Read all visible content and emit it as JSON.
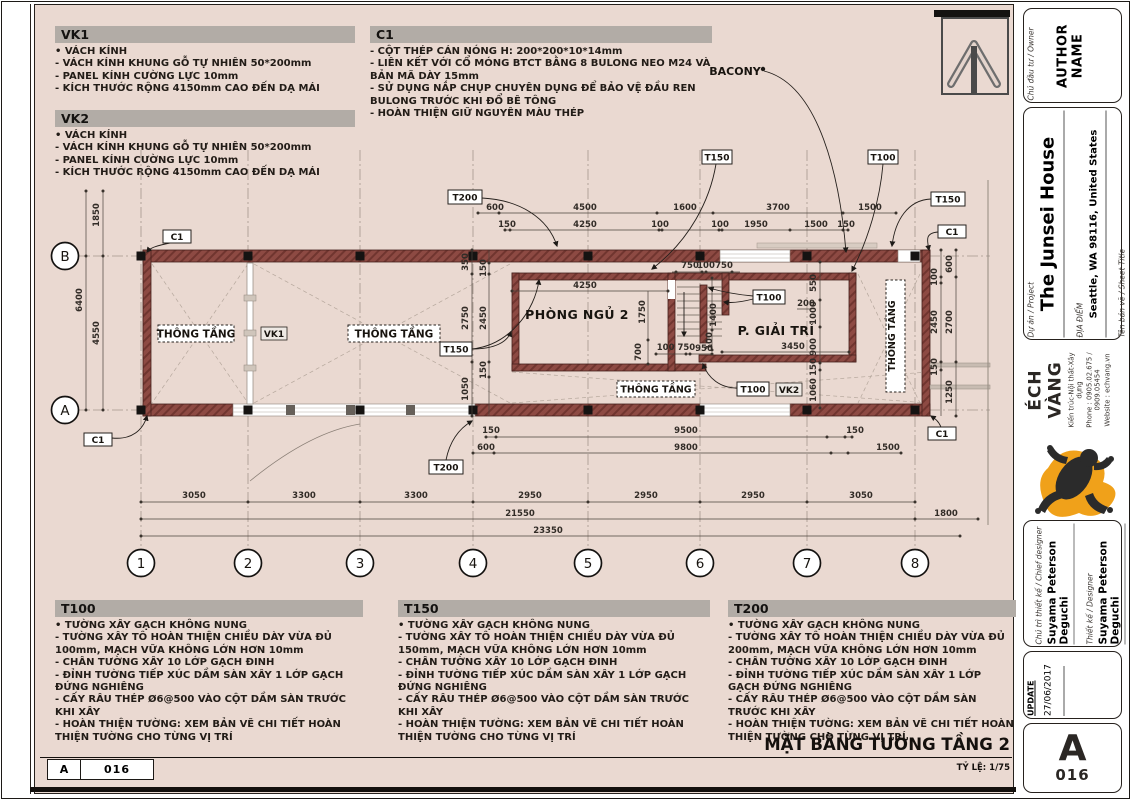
{
  "notes": {
    "vk1": {
      "title": "VK1",
      "lines": [
        "• VÁCH KÍNH",
        "- VÁCH KÍNH KHUNG GỖ TỰ NHIÊN 50*200mm",
        "- PANEL KÍNH CƯỜNG LỰC 10mm",
        "- KÍCH THƯỚC RỘNG 4150mm CAO ĐẾN DẠ MÁI"
      ]
    },
    "vk2": {
      "title": "VK2",
      "lines": [
        "• VÁCH KÍNH",
        "- VÁCH KÍNH KHUNG GỖ TỰ NHIÊN 50*200mm",
        "- PANEL KÍNH CƯỜNG LỰC 10mm",
        "- KÍCH THƯỚC RỘNG 4150mm CAO ĐẾN DẠ MÁI"
      ]
    },
    "c1": {
      "title": "C1",
      "lines": [
        "- CỘT THÉP CÁN NÓNG H: 200*200*10*14mm",
        "- LIÊN KẾT VỚI CỔ MÓNG BTCT BẰNG 8 BULONG NEO M24 VÀ BẢN MÃ DÀY 15mm",
        "- SỬ DỤNG NẮP CHỤP CHUYÊN DỤNG ĐỂ BẢO VỆ ĐẦU REN BULONG TRƯỚC KHI ĐỔ BÊ TÔNG",
        "- HOÀN THIỆN GIỮ NGUYÊN MÀU THÉP"
      ]
    },
    "t100": {
      "title": "T100",
      "lines": [
        "• TƯỜNG XÂY GẠCH KHÔNG NUNG",
        "- TƯỜNG XÂY TÔ HOÀN THIỆN CHIỀU DÀY VỪA ĐỦ 100mm, MẠCH VỮA KHÔNG LỚN HƠN 10mm",
        "- CHÂN TƯỜNG XÂY 10 LỚP GẠCH ĐINH",
        "- ĐỈNH TƯỜNG TIẾP XÚC DẦM SÀN XÂY 1 LỚP GẠCH ĐỨNG NGHIÊNG",
        "- CẤY RÂU THÉP Ø6@500 VÀO CỘT DẦM SÀN TRƯỚC KHI XÂY",
        "- HOÀN THIỆN TƯỜNG: XEM BẢN VẼ CHI TIẾT HOÀN THIỆN TƯỜNG CHO TỪNG VỊ TRÍ"
      ]
    },
    "t150": {
      "title": "T150",
      "lines": [
        "• TƯỜNG XÂY GẠCH KHÔNG NUNG",
        "- TƯỜNG XÂY TÔ HOÀN THIỆN CHIỀU DÀY VỪA ĐỦ 150mm, MẠCH VỮA KHÔNG LỚN HƠN 10mm",
        "- CHÂN TƯỜNG XÂY 10 LỚP GẠCH ĐINH",
        "- ĐỈNH TƯỜNG TIẾP XÚC DẦM SÀN XÂY 1 LỚP GẠCH ĐỨNG NGHIÊNG",
        "- CẤY RÂU THÉP Ø6@500 VÀO CỘT DẦM SÀN TRƯỚC KHI XÂY",
        "- HOÀN THIỆN TƯỜNG: XEM BẢN VẼ CHI TIẾT HOÀN THIỆN TƯỜNG CHO TỪNG VỊ TRÍ"
      ]
    },
    "t200": {
      "title": "T200",
      "lines": [
        "• TƯỜNG XÂY GẠCH KHÔNG NUNG",
        "- TƯỜNG XÂY TÔ HOÀN THIỆN CHIỀU DÀY VỪA ĐỦ 200mm, MẠCH VỮA KHÔNG LỚN HƠN 10mm",
        "- CHÂN TƯỜNG XÂY 10 LỚP GẠCH ĐINH",
        "- ĐỈNH TƯỜNG  TIẾP XÚC DẦM SÀN XÂY 1 LỚP GẠCH ĐỨNG NGHIÊNG",
        "- CẤY RÂU THÉP Ø6@500 VÀO CỘT DẦM SÀN TRƯỚC KHI XÂY",
        "- HOÀN THIỆN TƯỜNG: XEM BẢN VẼ CHI TIẾT HOÀN THIỆN TƯỜNG CHO TỪNG VỊ TRÍ"
      ]
    }
  },
  "plan": {
    "grid": {
      "cols": [
        "1",
        "2",
        "3",
        "4",
        "5",
        "6",
        "7",
        "8"
      ],
      "rows": [
        "B",
        "A"
      ]
    },
    "rooms": {
      "bedroom": "PHÒNG NGỦ 2",
      "entertain": "P. GIẢI TRÍ",
      "void": "THÔNG TẦNG",
      "balcony": "BACONY"
    },
    "tags": {
      "t100": "T100",
      "t150": "T150",
      "t200": "T200",
      "c1": "C1",
      "vk1": "VK1",
      "vk2": "VK2"
    },
    "dims": {
      "top1": [
        "600",
        "4500",
        "1600",
        "3700",
        "1500"
      ],
      "top2": [
        "150",
        "4250",
        "100",
        "100",
        "1950",
        "1500",
        "150"
      ],
      "left": [
        "1850",
        "6400",
        "4550"
      ],
      "inner_left": [
        "350",
        "150",
        "2750",
        "2450",
        "150",
        "1050"
      ],
      "bedroom": [
        "4250",
        "1750",
        "700",
        "100 750",
        "950",
        "750",
        "100",
        "750",
        "1400",
        "100"
      ],
      "right_room": [
        "3450",
        "200",
        "550",
        "1000",
        "900",
        "150",
        "1060"
      ],
      "right": [
        "600",
        "100",
        "2450",
        "2700",
        "150",
        "1250"
      ],
      "bottom_inner": [
        "150",
        "600",
        "9500",
        "9800",
        "150",
        "1500"
      ],
      "axes": [
        "3050",
        "3300",
        "3300",
        "2950",
        "2950",
        "2950",
        "3050"
      ],
      "totals": [
        "21550",
        "23350",
        "1800"
      ]
    }
  },
  "footer": {
    "drawing_title": "MẶT BẰNG TƯỜNG TẦNG 2",
    "scale": "TỶ LỆ: 1/75",
    "ref_rev": "A",
    "ref_num": "016"
  },
  "titleblock": {
    "owner_label": "Chủ đầu tư / Owner",
    "owner": "AUTHOR NAME",
    "project_label": "Dự án / Project",
    "project": "The Junsei House",
    "location_label": "ĐỊA ĐIỂM",
    "location": "Seattle, WA 98116, United States",
    "sheet_label": "Tên bản vẽ / Sheet Title",
    "sheet": "PAGE NAME",
    "firm": "ÉCH VÀNG",
    "firm_sub": "Kiến trúc-Nội thất-Xây dựng",
    "firm_phone": "Phone : 0905.02.675 / 0909.05454",
    "firm_web": "Website : echvang.vn",
    "chief_label": "Chủ trì thiết kế / Chief designer",
    "chief": "Suyama Peterson Deguchi",
    "designer_label": "Thiết kế / Designer",
    "designer": "Suyama Peterson Deguchi",
    "checker_label": "Kiểm / Checked by",
    "checker": "Huynh Van Phuc",
    "update_label": "UPDATE",
    "update_date": "27/06/2017",
    "rev": "A",
    "number": "016"
  }
}
